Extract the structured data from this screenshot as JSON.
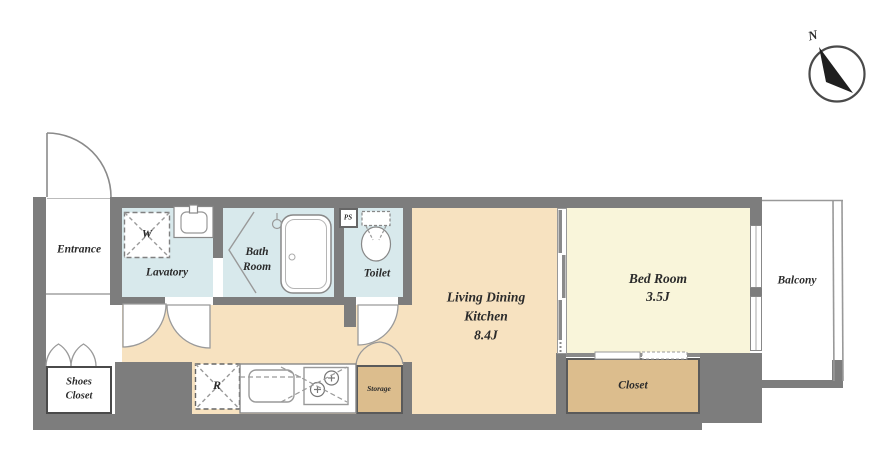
{
  "plan": {
    "compass": {
      "north": "N"
    },
    "rooms": {
      "entrance": {
        "label": "Entrance"
      },
      "lavatory": {
        "label": "Lavatory"
      },
      "bathroom": {
        "l1": "Bath",
        "l2": "Room"
      },
      "toilet": {
        "label": "Toilet"
      },
      "ps": {
        "label": "PS"
      },
      "ldk": {
        "l1": "Living Dining",
        "l2": "Kitchen",
        "l3": "8.4J"
      },
      "bedroom": {
        "l1": "Bed Room",
        "l2": "3.5J"
      },
      "balcony": {
        "label": "Balcony"
      },
      "closet": {
        "label": "Closet"
      },
      "storage": {
        "label": "Storage"
      },
      "shoes_closet": {
        "l1": "Shoes",
        "l2": "Closet"
      }
    },
    "fixtures": {
      "washer": "W",
      "refrigerator": "R"
    }
  },
  "colors": {
    "wall": "#7d7d7d",
    "wet": "#d8e9ec",
    "ldk": "#f7e2c0",
    "bed": "#f9f5da",
    "closet": "#dcbd8d",
    "ink": "#2b2b2b",
    "line": "#8a8a8a"
  }
}
